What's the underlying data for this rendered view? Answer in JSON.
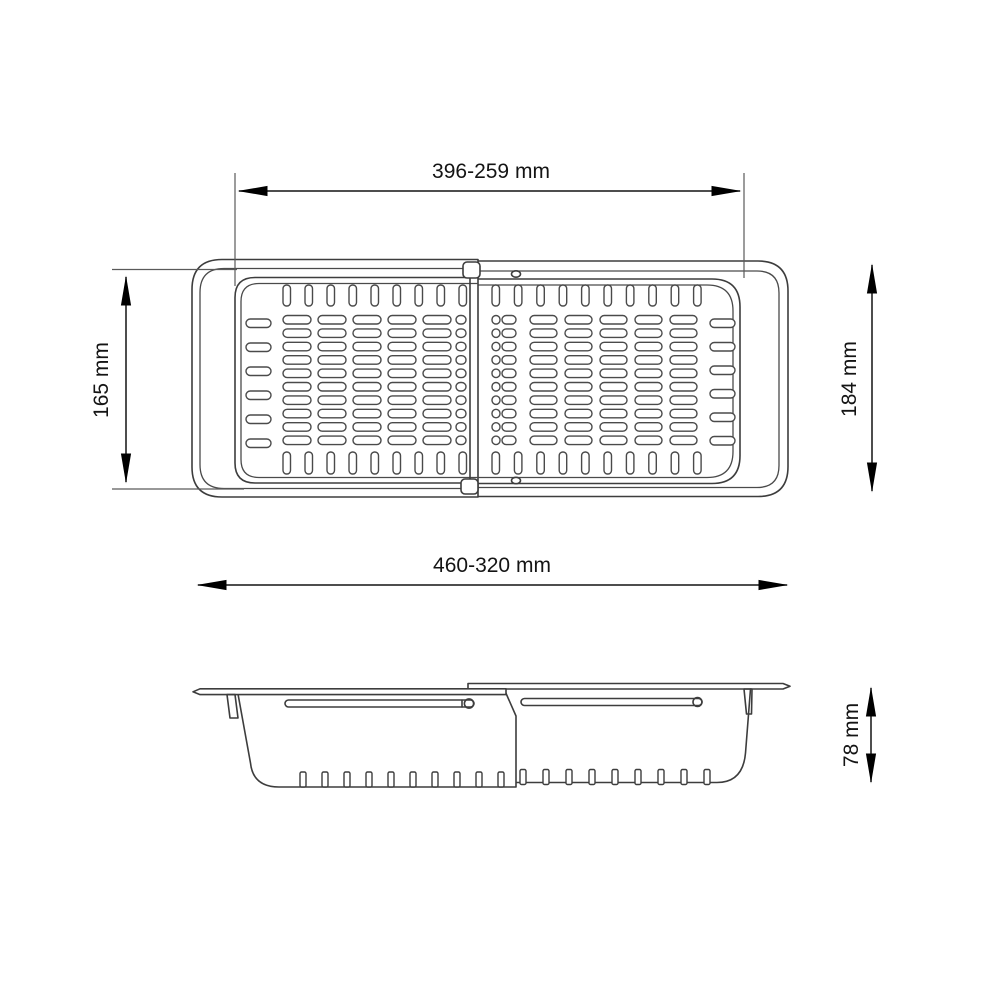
{
  "drawing": {
    "kind": "technical-dimension-drawing",
    "subject": "expandable sink colander / drainer tray, top view and side view",
    "background": "#ffffff",
    "line_color": "#3d3d3d",
    "dimension_color": "#141414",
    "views": {
      "top_view": {
        "dimensions": {
          "inner_width_range": "396-259 mm",
          "left_tray_depth": "165 mm",
          "right_tray_depth": "184 mm",
          "overall_length_range": "460-320 mm"
        }
      },
      "side_view": {
        "dimensions": {
          "height": "78 mm"
        }
      }
    }
  }
}
